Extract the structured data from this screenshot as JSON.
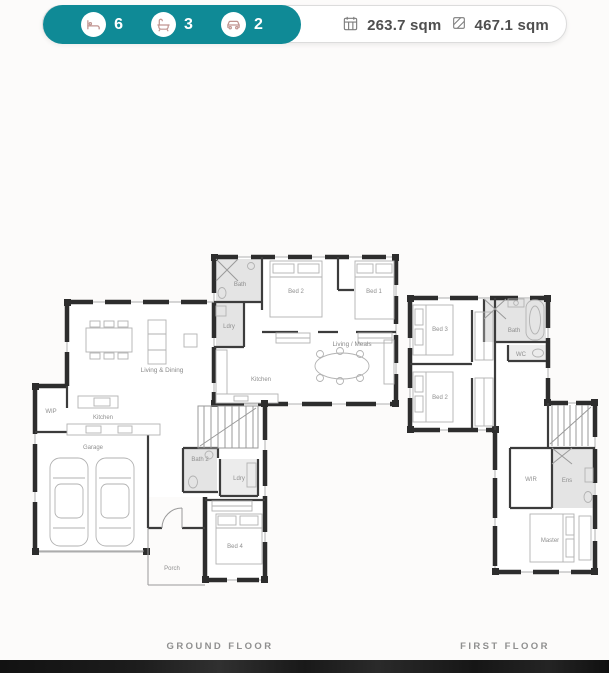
{
  "colors": {
    "teal": "#0f8a96",
    "wall": "#2d2d2d",
    "label_gray": "#8f8f8f",
    "bottom_bar": "#171717"
  },
  "stats_bar": {
    "stats": [
      {
        "icon": "bed-icon",
        "value": "6"
      },
      {
        "icon": "bath-icon",
        "value": "3"
      },
      {
        "icon": "car-icon",
        "value": "2"
      }
    ],
    "areas": [
      {
        "icon": "floor-area-icon",
        "value": "263.7 sqm"
      },
      {
        "icon": "land-area-icon",
        "value": "467.1 sqm"
      }
    ]
  },
  "floors": [
    {
      "caption": "GROUND FLOOR",
      "rooms": {
        "flat_bath": "Bath",
        "flat_bed2": "Bed 2",
        "flat_bed1": "Bed 1",
        "flat_ldry": "Ldry",
        "flat_kitchen": "Kitchen",
        "flat_living": "Living / Meals",
        "living_dining": "Living & Dining",
        "wip": "WIP",
        "kitchen": "Kitchen",
        "garage": "Garage",
        "bath2": "Bath 2",
        "ldry": "Ldry",
        "bed4": "Bed 4",
        "porch": "Porch"
      }
    },
    {
      "caption": "FIRST FLOOR",
      "rooms": {
        "bed3": "Bed 3",
        "bed2": "Bed 2",
        "bath": "Bath",
        "wc": "WC",
        "wir": "WIR",
        "ens": "Ens",
        "master": "Master"
      }
    }
  ]
}
